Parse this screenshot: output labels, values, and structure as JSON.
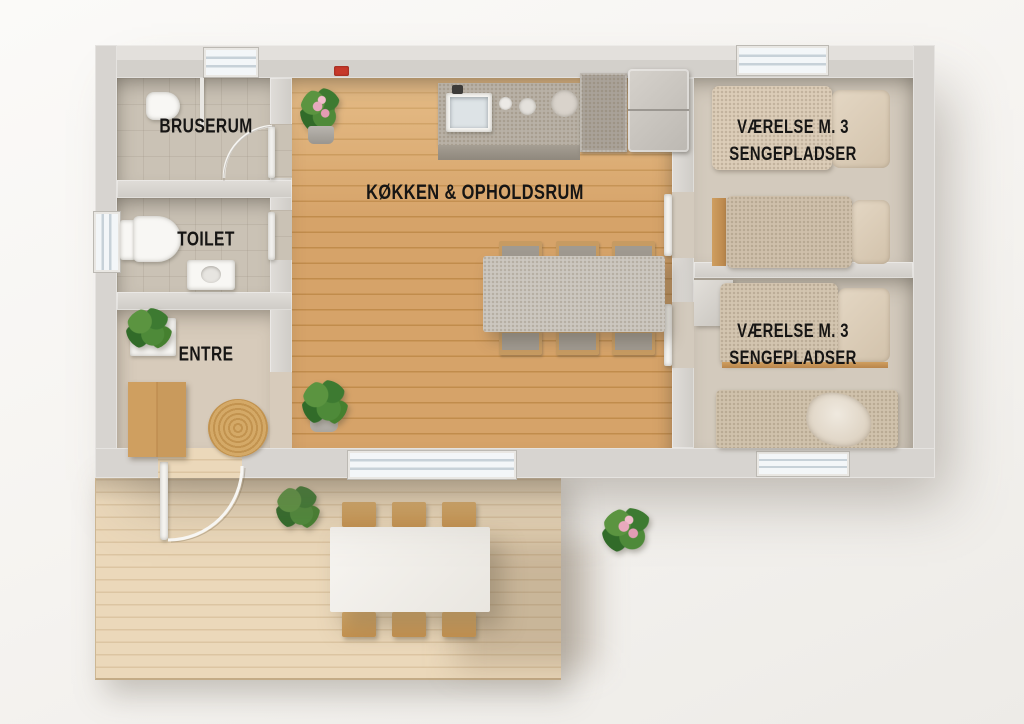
{
  "rooms": {
    "bruserum": {
      "label": "BRUSERUM"
    },
    "toilet": {
      "label": "TOILET"
    },
    "entre": {
      "label": "ENTRE"
    },
    "kitchen_living": {
      "label": "KØKKEN & OPHOLDSRUM"
    },
    "bedroom_top": {
      "label_line1": "VÆRELSE M. 3",
      "label_line2": "SENGEPLADSER"
    },
    "bedroom_bottom": {
      "label_line1": "VÆRELSE M. 3",
      "label_line2": "SENGEPLADSER"
    }
  },
  "palette": {
    "background": "#f6f4f1",
    "wall": "#d7d4d0",
    "wood_floor": "#d2a066",
    "deck_wood": "#e9d5b6",
    "bedroom_floor": "#d3cabd",
    "bathroom_tile": "#cac2b5",
    "label_text": "#161514",
    "smoke_detector_red": "#c6392a",
    "plant_green": "#3d7a31",
    "flower_pink": "#e8a9bd"
  }
}
